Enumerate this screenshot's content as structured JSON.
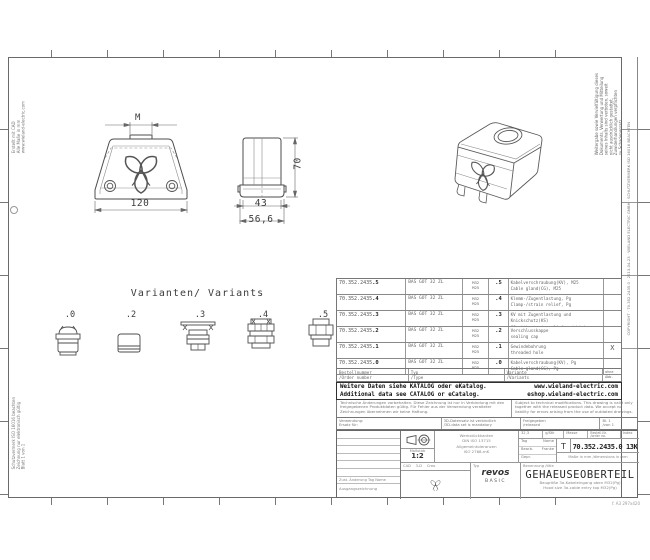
{
  "frame": {
    "format_note": "f. A3 297x420"
  },
  "views": {
    "front": {
      "thread_label": "M",
      "width_label": "120"
    },
    "side": {
      "width_label": "43",
      "flange_label": "56,6",
      "height_label": "70"
    }
  },
  "variants": {
    "heading": "Varianten/ Variants",
    "items": [
      {
        "label": ".0"
      },
      {
        "label": ".2"
      },
      {
        "label": ".3"
      },
      {
        "label": ".4"
      },
      {
        "label": ".5"
      }
    ]
  },
  "table": {
    "rows": [
      {
        "part_base": "70.352.2435",
        "part_suffix": ".5",
        "type": "BAS GOT 32 ZL",
        "m_top": "M32",
        "m_bot": "M25",
        "idx": ".5",
        "desc_de": "Kabelverschraubung(KV), M25",
        "desc_en": "Cable gland(CG), M25",
        "mark": ""
      },
      {
        "part_base": "70.352.2435",
        "part_suffix": ".4",
        "type": "BAS GOT 32 ZL",
        "m_top": "M32",
        "m_bot": "M25",
        "idx": ".4",
        "desc_de": "Klemm-/Zugentlastung, Pg",
        "desc_en": "Clamp-/strain relief, Pg",
        "mark": ""
      },
      {
        "part_base": "70.352.2435",
        "part_suffix": ".3",
        "type": "BAS GOT 32 ZL",
        "m_top": "M32",
        "m_bot": "M25",
        "idx": ".3",
        "desc_de": "KV mit Zugentlastung und Knickschutz(KS)",
        "desc_en": "CG with strain relief and kink prot.(KS)",
        "mark": ""
      },
      {
        "part_base": "70.352.2435",
        "part_suffix": ".2",
        "type": "BAS GOT 32 ZL",
        "m_top": "M32",
        "m_bot": "M25",
        "idx": ".2",
        "desc_de": "Verschlusskappe",
        "desc_en": "sealing cap",
        "mark": ""
      },
      {
        "part_base": "70.352.2435",
        "part_suffix": ".1",
        "type": "BAS GOT 32 ZL",
        "m_top": "M32",
        "m_bot": "M25",
        "idx": ".1",
        "desc_de": "Gewindebohrung",
        "desc_en": "threaded hole",
        "mark": "X"
      },
      {
        "part_base": "70.352.2435",
        "part_suffix": ".0",
        "type": "BAS GOT 32 ZL",
        "m_top": "M32",
        "m_bot": "M25",
        "idx": ".0",
        "desc_de": "Kabelverschraubung(KV), Pg",
        "desc_en": "Cable gland(CG), Pg",
        "mark": ""
      }
    ],
    "footer": {
      "order_no": "Bestellnummer\n/Order number",
      "type": "Typ\n/Type",
      "variant": "Variante\n/Variants",
      "mark_head": "ohne\nAbb."
    },
    "banner": {
      "de": "Weitere Daten siehe KATALOG oder eKatalog.",
      "en": "Additional data see CATALOG or eCatalog.",
      "url_de": "www.wieland-electric.com",
      "url_en": "eshop.wieland-electric.com"
    }
  },
  "disclaimer": {
    "de": "Technische Änderungen vorbehalten. Diese Zeichnung ist nur in Verbindung mit den freigegebenen Produktdaten gültig. Für Fehler aus der Verwendung veralteter Zeichnungen übernehmen wir keine Haftung.",
    "en": "Subject to technical modifications. This drawing is valid only together with the released product data. We accept no liability for errors arising from the use of outdated drawings."
  },
  "row_a": {
    "c1": "Verwendung:\nErsatz für:",
    "c2": "3D-Datensatz ist verbindlich\n/3D-data set is mandatory",
    "c3": "Freigegeben\n/released",
    "c4": "Bl. 1\n/von 1"
  },
  "titleblock": {
    "rev_header": "Zust. Änderung  Tag  Name",
    "origin": "Ausgangszeichnung",
    "scale_label": "Maßstab",
    "scale": "1:2",
    "notes": "Werkstückkanten\nDIN ISO 13715\nAllgemeintoleranzen\nISO 2768-mK",
    "cad": "CAD    3-D    Creo",
    "names": {
      "h_date": "Tag",
      "h_name": "Name",
      "r1": "Bearb.",
      "r1v": "Franke",
      "r2": "Gepr.",
      "r2v": "",
      "r3": "Norm",
      "r3v": ""
    },
    "mass_value": "32,3",
    "mass_unit": "g/Stk",
    "mass_label": "Masse",
    "partno_label": "Bestell-Nr.\n/order no.",
    "index_label": "Index",
    "t": "T",
    "part_no": "70.352.2435.0 13K",
    "note_line": "Maße in mm /dimensions in mm",
    "brand": "wieland",
    "brand_sub": "Wieland Electric GmbH\n96045 Bamberg",
    "type_label": "Typ",
    "series": "revos",
    "series_sub": "BASIC",
    "title_label": "Benennung /title",
    "title": "GEHAEUSEOBERTEIL",
    "subtitle_de": "Baugröße 3a-Kabeleingang oben M32(Pg)",
    "subtitle_en": "Hood size 3a-cable entry top M32(Pg)"
  },
  "margins": {
    "right_notice": "Weitergabe sowie Vervielfältigung dieses\nDokuments, Verwertung und Mitteilung\nseines Inhalts sind verboten, soweit\nnicht ausdrücklich gestattet.\nZuwiderhandlungen verpflichten\nzu Schadenersatz.",
    "right_strip": "COPYRIGHT · 70.352.2435.0 · 2013-04-23 · WIELAND ELECTRIC GMBH · SCHUTZVERMERK ISO 16016 BEACHTEN",
    "left_top": "Erstellt mit CAD\nAlle Maße in mm\nwww.wieland-electric.com",
    "left_bottom": "Schutzvermerk ISO 16016 beachten\nZeichnung nur elektronisch gültig\nBlatt 1 von 1"
  }
}
